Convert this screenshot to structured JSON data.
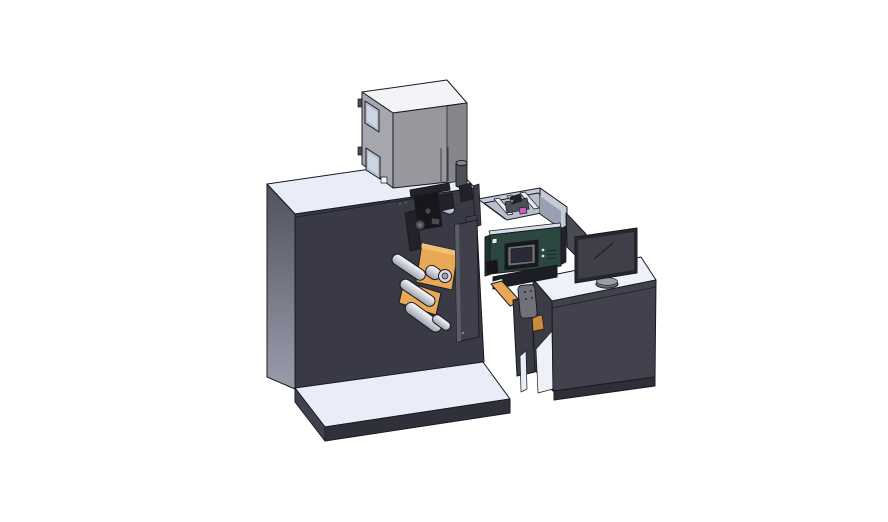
{
  "scene": {
    "description": "3D CAD isometric render of an industrial label printing machine: dark cabinet with printer housing on top, web-path mechanism with orange plates and white rollers, scanner enclosure with teal control panel, connected to an operator desk with a monitor",
    "background": "#ffffff"
  },
  "palette": {
    "background": "#ffffff",
    "outline": "#1a1a20",
    "cabinet_front": "#3a3a46",
    "cabinet_side_top": "#4e525e",
    "cabinet_side_bottom": "#9a9eac",
    "surface_light": "#e9edf8",
    "platform_front": "#30303a",
    "platform_side": "#42424e",
    "box_front": "#97979d",
    "box_side": "#a6a6ae",
    "box_right": "#85858b",
    "box_top": "#f3f4f7",
    "window_glass": "#b4bdcd",
    "window_glass_inner": "#ccd4e1",
    "window_frame": "#3f444d",
    "cylinder_body": "#4e4e56",
    "cylinder_cap": "#85858d",
    "orange": "#e8a855",
    "orange_light": "#f2c077",
    "orange_dark": "#c98a3a",
    "roller_light": "#fdfdfe",
    "roller_mid": "#c7cad2",
    "roller_dark": "#9da1ab",
    "mech_black": "#16161b",
    "mech_dark": "#22222b",
    "mech_gray": "#4a4a52",
    "mech_gray_light": "#6e727c",
    "door_panel": "#40404c",
    "door_edge": "#5c5c68",
    "encl_wall": "#c6cbd8",
    "encl_wall_shadow": "#9aa0af",
    "encl_floor": "#b9bfcc",
    "encl_rib": "#e8ecf4",
    "encl_block": "#4e4e58",
    "magenta": "#c45fc0",
    "teal": "#2c473f",
    "teal_dark": "#1e352f",
    "teal_top": "#d7dce6",
    "screen_bezel": "#17171c",
    "screen_frame": "#70737c",
    "screen_fill": "#2a2a34",
    "desk_front": "#42424e",
    "desk_side": "#3c3c46",
    "desk_plinth": "#2f2f39",
    "desk_inner": "#eef1f8",
    "monitor_bezel": "#26262c",
    "monitor_screen": "#3f3f49",
    "monitor_line": "#cdd1d9",
    "stand_top": "#9a9eaa",
    "stand_bottom": "#6a6e78",
    "stand_neck": "#5f636e",
    "side_panel": "#4a4a54",
    "beam_dark": "#1d1d25",
    "beam_highlight": "#e2e5ec",
    "leg_dark": "#3b3b45",
    "device_gray": "#71717b",
    "device_dots": "#2a2a32",
    "white_trim": "#e9edf6",
    "seam": "#2b2b33",
    "box_seam": "#6f6f76",
    "dot_light": "#d6dae2",
    "vent": "#8f959e",
    "gap_dark": "#23232b"
  },
  "parts": [
    {
      "name": "machine-cabinet",
      "color_key": "cabinet_front"
    },
    {
      "name": "base-platform",
      "color_key": "surface_light"
    },
    {
      "name": "printer-housing",
      "color_key": "box_front"
    },
    {
      "name": "exhaust-cylinder",
      "color_key": "cylinder_body"
    },
    {
      "name": "web-mechanism-orange-plates",
      "color_key": "orange"
    },
    {
      "name": "web-rollers",
      "color_key": "roller_mid"
    },
    {
      "name": "print-head-assembly",
      "color_key": "mech_black"
    },
    {
      "name": "access-door-panel",
      "color_key": "door_panel"
    },
    {
      "name": "scanner-enclosure",
      "color_key": "encl_wall"
    },
    {
      "name": "control-panel-box",
      "color_key": "teal"
    },
    {
      "name": "control-panel-screen",
      "color_key": "screen_bezel"
    },
    {
      "name": "bridge-conveyor",
      "color_key": "beam_dark"
    },
    {
      "name": "handheld-device",
      "color_key": "device_gray"
    },
    {
      "name": "operator-desk",
      "color_key": "desk_front"
    },
    {
      "name": "desk-monitor",
      "color_key": "monitor_bezel"
    },
    {
      "name": "side-display-panel",
      "color_key": "side_panel"
    }
  ]
}
